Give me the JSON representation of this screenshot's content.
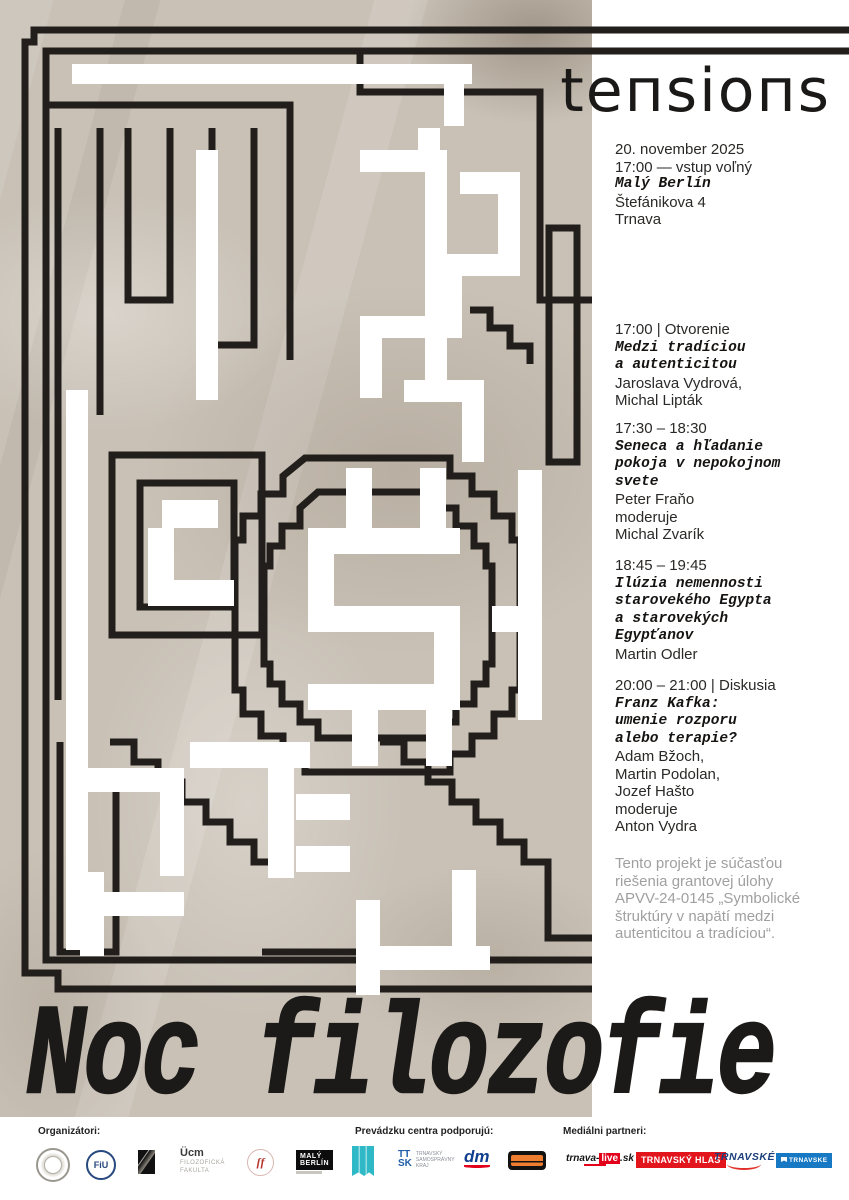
{
  "poster": {
    "title": "tensions",
    "main_title": "Noc filozofie",
    "info": {
      "date": "20. november 2025",
      "entry": "17:00 — vstup voľný",
      "venue": "Malý Berlín",
      "street": "Štefánikova 4",
      "city": "Trnava"
    },
    "schedule": [
      {
        "time": "17:00 | Otvorenie",
        "title_lines": [
          "Medzi tradíciou",
          "a autenticitou"
        ],
        "people_lines": [
          "Jaroslava Vydrová,",
          "Michal Lipták"
        ]
      },
      {
        "time": "17:30 – 18:30",
        "title_lines": [
          "Seneca a hľadanie",
          "pokoja v nepokojnom",
          "svete"
        ],
        "people_lines": [
          "Peter Fraňo",
          "moderuje",
          "Michal Zvarík"
        ]
      },
      {
        "time": "18:45 – 19:45",
        "title_lines": [
          "Ilúzia nemennosti",
          "starovekého Egypta",
          "a starovekých",
          "Egypťanov"
        ],
        "people_lines": [
          "Martin Odler"
        ]
      },
      {
        "time": "20:00 – 21:00 | Diskusia",
        "title_lines": [
          "Franz Kafka:",
          "umenie rozporu",
          "alebo terapie?"
        ],
        "people_lines": [
          "Adam Bžoch,",
          "Martin Podolan,",
          "Jozef Hašto",
          "moderuje",
          "Anton Vydra"
        ]
      }
    ],
    "grant_lines": [
      "Tento projekt je súčasťou",
      "riešenia grantovej úlohy",
      "APVV-24-0145 „Symbolické",
      "štruktúry v napätí medzi",
      "autenticitou a tradíciou“."
    ]
  },
  "footer": {
    "organizers_label": "Organizátori:",
    "sponsors_label": "Prevádzku centra podporujú:",
    "media_label": "Mediálni partneri:",
    "organizers": [
      {
        "id": "sav-circle-logo"
      },
      {
        "id": "fiu-circle-logo",
        "text": "FiU"
      },
      {
        "id": "black-square-logo"
      },
      {
        "id": "ucm-logo",
        "big": "Ücm",
        "line1": "FILOZOFICKÁ",
        "line2": "FAKULTA"
      },
      {
        "id": "red-circle-logo",
        "text": "ſf"
      },
      {
        "id": "maly-berlin-logo",
        "line1": "MALÝ",
        "line2": "BERLÍN"
      }
    ],
    "sponsors": [
      {
        "id": "teal-flag-logo"
      },
      {
        "id": "ttsk-logo",
        "big": "TT SK",
        "line1": "TRNAVSKÝ",
        "line2": "SAMOSPRÁVNY",
        "line3": "KRAJ"
      },
      {
        "id": "dm-logo",
        "text": "dm"
      },
      {
        "id": "orange-badge-logo"
      }
    ],
    "media": [
      {
        "id": "trnava-live-logo",
        "part1": "trnava-",
        "part2": "live",
        "part3": ".sk"
      },
      {
        "id": "trnavsky-hlas-logo",
        "text": "TRNAVSKÝ HLAS"
      },
      {
        "id": "trnavske-radio-logo",
        "text": "TRNAVSKÉ"
      },
      {
        "id": "trnavske-blue-logo",
        "text": "TRNAVSKE"
      }
    ]
  },
  "colors": {
    "ink": "#211e1b",
    "paper": "#c9c1b6",
    "grant_gray": "#a0a0a0",
    "teal": "#2fb9c7",
    "red": "#e2151c",
    "blue": "#1779c4"
  }
}
